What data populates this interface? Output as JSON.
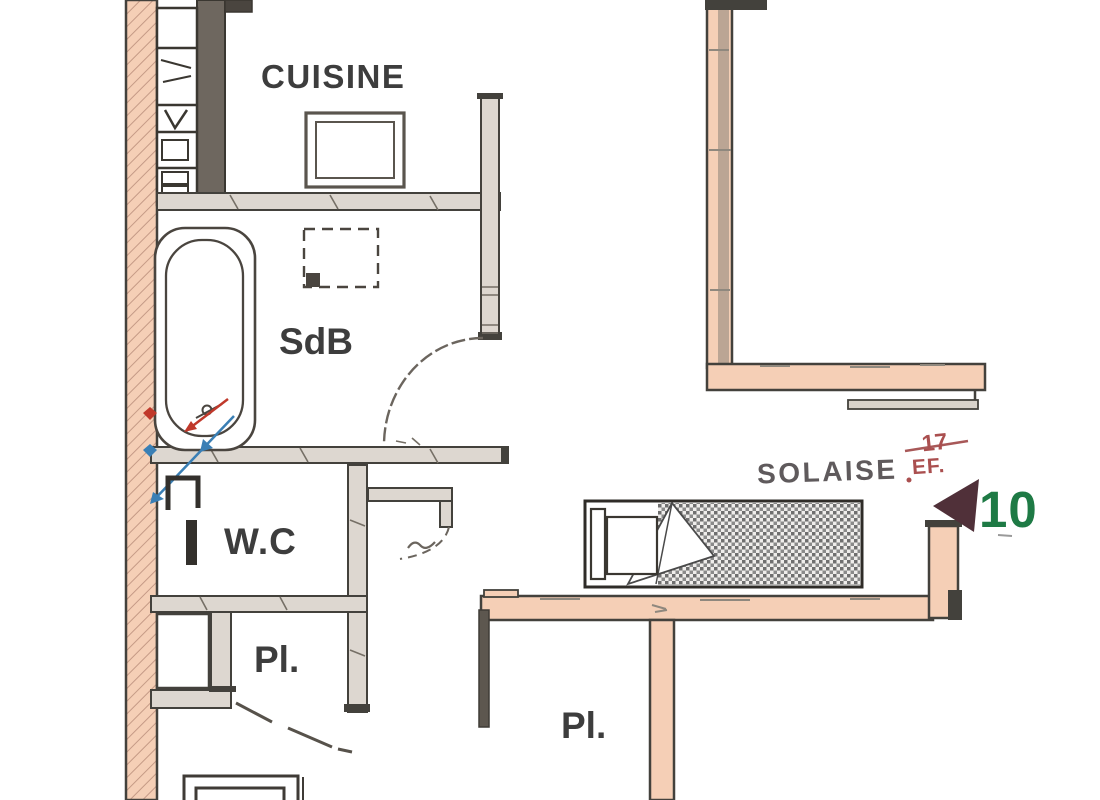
{
  "plan": {
    "rooms": [
      {
        "id": "cuisine",
        "label": "CUISINE"
      },
      {
        "id": "sdb",
        "label": "SdB"
      },
      {
        "id": "wc",
        "label": "W.C"
      },
      {
        "id": "pl_left",
        "label": "Pl."
      },
      {
        "id": "pl_right",
        "label": "Pl."
      }
    ],
    "annotations": {
      "street_name": "SOLAISE",
      "ref_number": "17",
      "water_supply": "EF.",
      "unit_number": "10"
    },
    "colors": {
      "exterior_wall_fill": "#f5cfb6",
      "interior_wall_fill": "#ddd7d0",
      "wall_stroke": "#43413c",
      "room_label": "#3d3d3d",
      "street_label": "#5f5a5c",
      "annotation_red": "#aa4f4f",
      "unit_number_green": "#1e7a45",
      "entrance_arrow": "#503039",
      "cold_water_blue": "#3a7fb5",
      "hot_water_red": "#c0392b"
    }
  }
}
